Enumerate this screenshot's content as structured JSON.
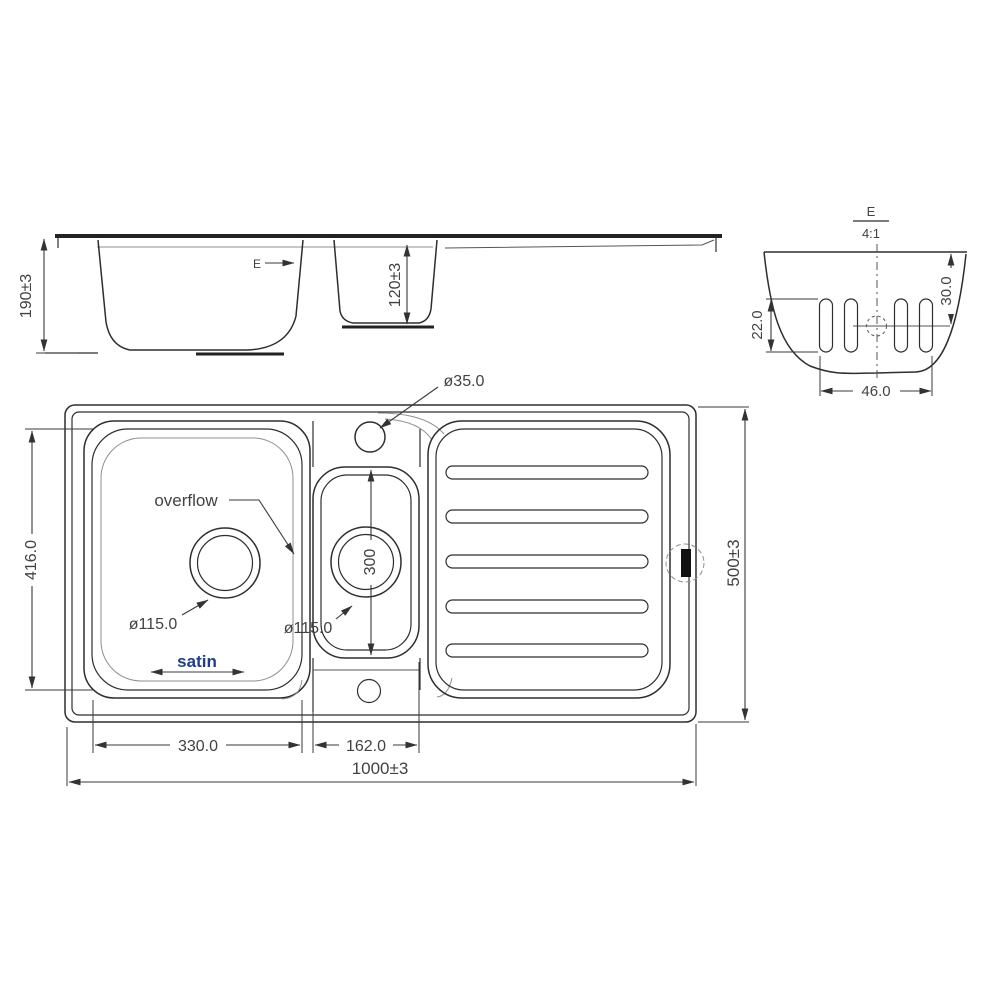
{
  "drawing": {
    "background": "#ffffff",
    "line_color": "#2e2e2e",
    "accent_color": "#1b3e8f",
    "side_view": {
      "height_dim": "190±3",
      "small_bowl_depth_dim": "120±3",
      "detail_marker": "E"
    },
    "detail_view": {
      "label": "E",
      "scale": "4:1",
      "slot_height_dim": "22.0",
      "offset_dim": "30.0",
      "width_dim": "46.0"
    },
    "plan_view": {
      "overflow_label": "overflow",
      "finish_label": "satin",
      "tap_hole_dim": "ø35.0",
      "main_drain_dim": "ø115.0",
      "small_drain_dim": "ø115.0",
      "small_bowl_length_dim": "300",
      "main_bowl_length_dim": "416.0",
      "main_bowl_width_dim": "330.0",
      "small_bowl_width_dim": "162.0",
      "overall_width_dim": "1000±3",
      "overall_depth_dim": "500±3"
    }
  }
}
